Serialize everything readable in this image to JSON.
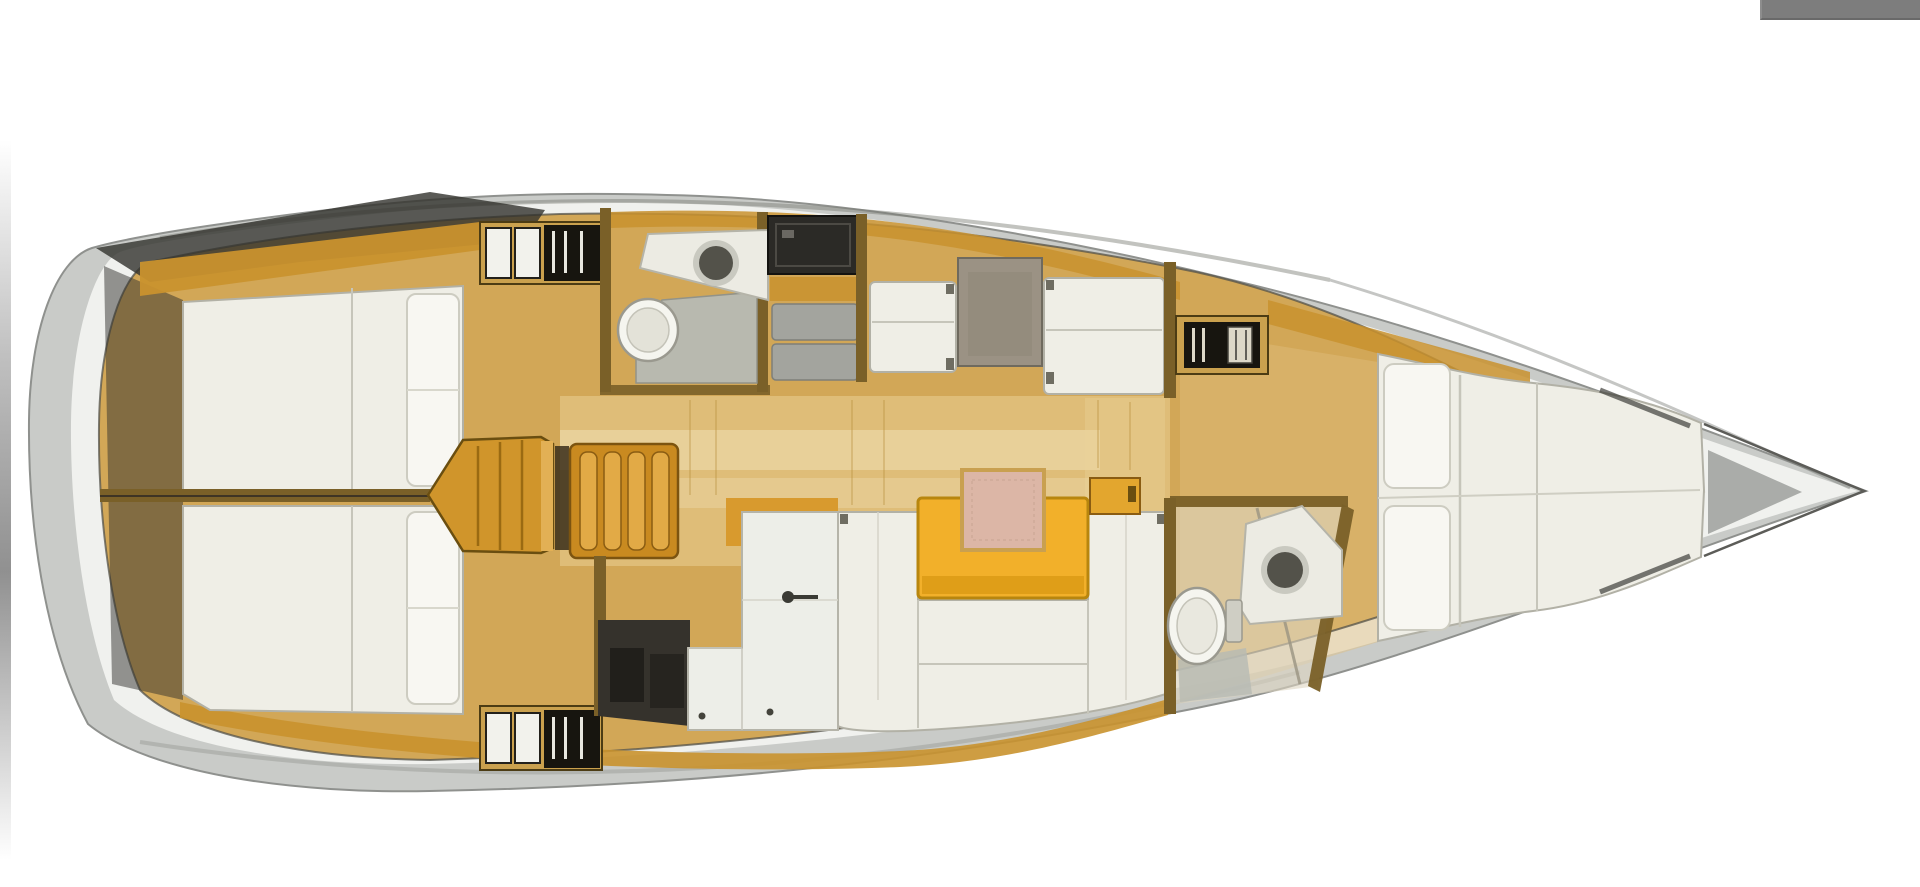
{
  "meta": {
    "content_type": "yacht-interior-floor-plan",
    "orientation": "bow-right-stern-left",
    "visible_text": "none"
  },
  "regions": [
    "aft-cabin-port",
    "aft-cabin-starboard",
    "engine-compartment",
    "companionway-steps",
    "aft-head",
    "galley",
    "dinette",
    "salon",
    "forward-head",
    "forward-cabin-v-berth",
    "bow-deck"
  ],
  "colors": {
    "page_bg": "#ffffff",
    "top_bar": "#7d7d7d",
    "hull": "#c9cbc8",
    "deck": "#f0f1ee",
    "deck_gray": "#a2a4a1",
    "shadow_dark": "#32322d",
    "floor": "#d2a757",
    "floor_light": "#ecd49a",
    "wood_band": "#c9922e",
    "wood_wall": "#7a6028",
    "wood_cabinet": "#caa14e",
    "step_orange": "#c98a20",
    "engine_orange": "#d0952b",
    "cushion": "#efeee6",
    "cushion_hi": "#f8f7f2",
    "cushion_line": "#b2b1a6",
    "table_gray": "#9b9284",
    "table_yellow": "#f2b02a",
    "pink": "#dcb6a6",
    "stove": "#2b2a26",
    "appliance": "#a3a49e",
    "shower": "#b7bab4",
    "sink": "#53524a",
    "sink_rim": "#c9c9c0",
    "toilet": "#f5f5ef",
    "locker_black": "#17150f",
    "locker_white": "#f2f2ec",
    "counter_white": "#edeee8",
    "dark_floor": "#35322c"
  }
}
